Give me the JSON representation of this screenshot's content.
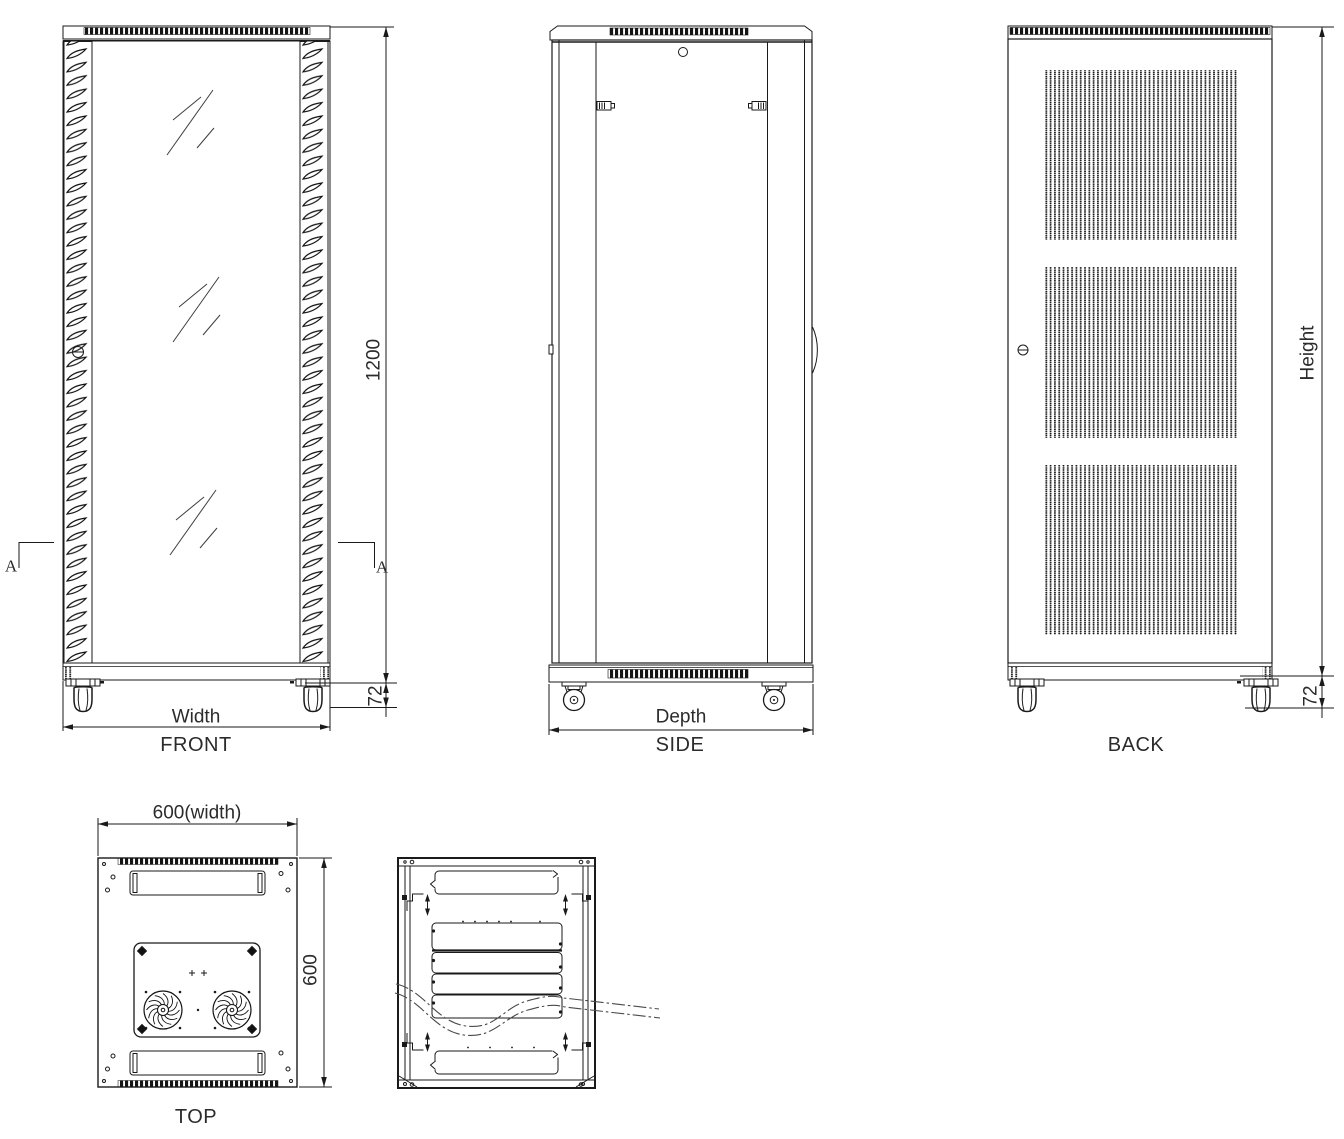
{
  "views": {
    "front": {
      "label": "FRONT",
      "width_dim": "Width",
      "height_dim": "1200",
      "caster_dim": "72",
      "section_marker": "A"
    },
    "side": {
      "label": "SIDE",
      "depth_dim": "Depth"
    },
    "back": {
      "label": "BACK",
      "height_dim": "Height",
      "caster_dim": "72"
    },
    "top": {
      "label": "TOP",
      "width_dim": "600(width)",
      "depth_dim": "600"
    }
  },
  "colors": {
    "line": "#1a1a1a",
    "text": "#2b2b2b",
    "background": "#ffffff"
  }
}
